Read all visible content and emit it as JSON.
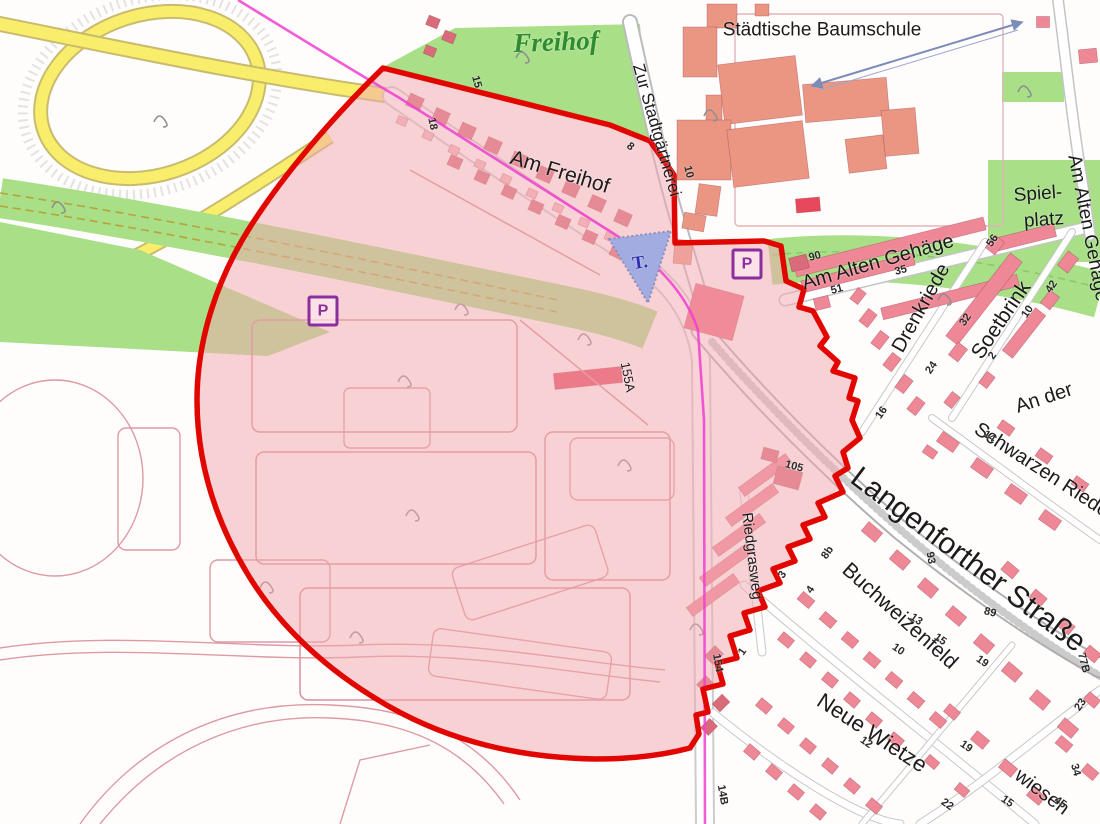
{
  "map": {
    "colors": {
      "highlight_red": "#e10600",
      "zone_pink": "#f2a9b0",
      "green": "#a8df87",
      "yellow_road": "#f9ee6b",
      "water_blue": "#a3ace0",
      "salmon_building": "#ea9683",
      "pink_building": "#ef8896",
      "dark_pink_building": "#d96b7a",
      "red_building": "#e8485c",
      "parking": "#8b2fa0",
      "railway_magenta": "#ee3fd0",
      "label_green": "#2e8b2e",
      "parcel_outline": "#dd9aa5"
    },
    "area_labels": [
      {
        "name": "area-label-freihof",
        "text": "Freihof",
        "x": 556,
        "y": 42,
        "rot": -2,
        "size": 27,
        "color": "#2e8b2e",
        "serif": true
      },
      {
        "name": "area-label-staedtische-baumschule",
        "text": "Städtische Baumschule",
        "x": 822,
        "y": 30,
        "rot": 0,
        "size": 19
      },
      {
        "name": "area-label-spielplatz-line1",
        "text": "Spiel-",
        "x": 1038,
        "y": 194,
        "rot": -4,
        "size": 19
      },
      {
        "name": "area-label-spielplatz-line2",
        "text": "platz",
        "x": 1044,
        "y": 220,
        "rot": -4,
        "size": 19
      }
    ],
    "street_labels": [
      {
        "name": "street-label-zur-stadtgaertnerei",
        "text": "Zur Stadtgärtnerei",
        "x": 657,
        "y": 130,
        "rot": 74,
        "size": 17
      },
      {
        "name": "street-label-am-freihof",
        "text": "Am Freihof",
        "x": 560,
        "y": 172,
        "rot": 17,
        "size": 21
      },
      {
        "name": "street-label-am-alten-gehaege",
        "text": "Am Alten Gehäge",
        "x": 878,
        "y": 262,
        "rot": -16,
        "size": 20
      },
      {
        "name": "street-label-am-alten-gehaege-east",
        "text": "Am Alten Gehäge",
        "x": 1088,
        "y": 228,
        "rot": 79,
        "size": 19
      },
      {
        "name": "street-label-drenkriede",
        "text": "Drenkriede",
        "x": 921,
        "y": 308,
        "rot": -61,
        "size": 20
      },
      {
        "name": "street-label-soetbrink",
        "text": "Soetbrink",
        "x": 1001,
        "y": 320,
        "rot": -56,
        "size": 21
      },
      {
        "name": "street-label-an-der",
        "text": "An der",
        "x": 1044,
        "y": 398,
        "rot": -18,
        "size": 20
      },
      {
        "name": "street-label-schwarzen-riede",
        "text": "Schwarzen Riede",
        "x": 1042,
        "y": 470,
        "rot": 33,
        "size": 20
      },
      {
        "name": "street-label-langenforther-strasse",
        "text": "Langenforther Straße",
        "x": 968,
        "y": 560,
        "rot": 37,
        "size": 30
      },
      {
        "name": "street-label-buchweizenfeld",
        "text": "Buchweizenfeld",
        "x": 900,
        "y": 616,
        "rot": 42,
        "size": 21
      },
      {
        "name": "street-label-neue-wietze",
        "text": "Neue Wietze",
        "x": 872,
        "y": 733,
        "rot": 33,
        "size": 22
      },
      {
        "name": "street-label-wiesen",
        "text": "wiesen",
        "x": 1042,
        "y": 792,
        "rot": 37,
        "size": 20
      },
      {
        "name": "street-label-riedgrasweg",
        "text": "Riedgrasweg",
        "x": 752,
        "y": 556,
        "rot": 83,
        "size": 15
      },
      {
        "name": "house-number-155a",
        "text": "155A",
        "x": 628,
        "y": 377,
        "rot": 79,
        "size": 13
      }
    ],
    "house_numbers": [
      {
        "t": "15",
        "x": 476,
        "y": 82,
        "rot": 75
      },
      {
        "t": "18",
        "x": 432,
        "y": 124,
        "rot": 78
      },
      {
        "t": "8",
        "x": 630,
        "y": 147,
        "rot": 40
      },
      {
        "t": "10",
        "x": 688,
        "y": 172,
        "rot": 76
      },
      {
        "t": "90",
        "x": 815,
        "y": 257,
        "rot": -15
      },
      {
        "t": "35",
        "x": 901,
        "y": 271,
        "rot": -15
      },
      {
        "t": "51",
        "x": 837,
        "y": 290,
        "rot": -15
      },
      {
        "t": "56",
        "x": 993,
        "y": 241,
        "rot": -55
      },
      {
        "t": "42",
        "x": 1052,
        "y": 287,
        "rot": -55
      },
      {
        "t": "10",
        "x": 1028,
        "y": 312,
        "rot": -55
      },
      {
        "t": "32",
        "x": 966,
        "y": 320,
        "rot": -55
      },
      {
        "t": "2",
        "x": 993,
        "y": 356,
        "rot": -55
      },
      {
        "t": "24",
        "x": 932,
        "y": 368,
        "rot": -55
      },
      {
        "t": "16",
        "x": 882,
        "y": 413,
        "rot": -55
      },
      {
        "t": "14",
        "x": 989,
        "y": 437,
        "rot": 33
      },
      {
        "t": "105",
        "x": 794,
        "y": 467,
        "rot": 15
      },
      {
        "t": "93",
        "x": 930,
        "y": 558,
        "rot": 80
      },
      {
        "t": "89",
        "x": 990,
        "y": 613,
        "rot": 15
      },
      {
        "t": "13",
        "x": 916,
        "y": 620,
        "rot": 35
      },
      {
        "t": "15",
        "x": 940,
        "y": 640,
        "rot": 35
      },
      {
        "t": "10",
        "x": 898,
        "y": 650,
        "rot": 35
      },
      {
        "t": "19",
        "x": 982,
        "y": 662,
        "rot": 35
      },
      {
        "t": "77B",
        "x": 1083,
        "y": 663,
        "rot": 75
      },
      {
        "t": "23",
        "x": 1081,
        "y": 705,
        "rot": -55
      },
      {
        "t": "34",
        "x": 1075,
        "y": 770,
        "rot": 75
      },
      {
        "t": "45",
        "x": 1060,
        "y": 803,
        "rot": 35
      },
      {
        "t": "15",
        "x": 1007,
        "y": 802,
        "rot": 35
      },
      {
        "t": "19",
        "x": 966,
        "y": 747,
        "rot": 35
      },
      {
        "t": "22",
        "x": 947,
        "y": 805,
        "rot": 35
      },
      {
        "t": "12",
        "x": 866,
        "y": 743,
        "rot": 35
      },
      {
        "t": "3",
        "x": 783,
        "y": 575,
        "rot": -55
      },
      {
        "t": "4",
        "x": 811,
        "y": 590,
        "rot": -55
      },
      {
        "t": "8b",
        "x": 828,
        "y": 553,
        "rot": -55
      },
      {
        "t": "1",
        "x": 743,
        "y": 652,
        "rot": -55
      },
      {
        "t": "154",
        "x": 717,
        "y": 663,
        "rot": 80
      },
      {
        "t": "14B",
        "x": 722,
        "y": 795,
        "rot": 80
      }
    ],
    "symbols": {
      "parking_label": "P",
      "parking_positions": [
        {
          "x": 323,
          "y": 311
        },
        {
          "x": 747,
          "y": 264
        }
      ],
      "pond_label": {
        "text": "T.",
        "x": 640,
        "y": 262,
        "rot": -8,
        "size": 18
      }
    }
  }
}
